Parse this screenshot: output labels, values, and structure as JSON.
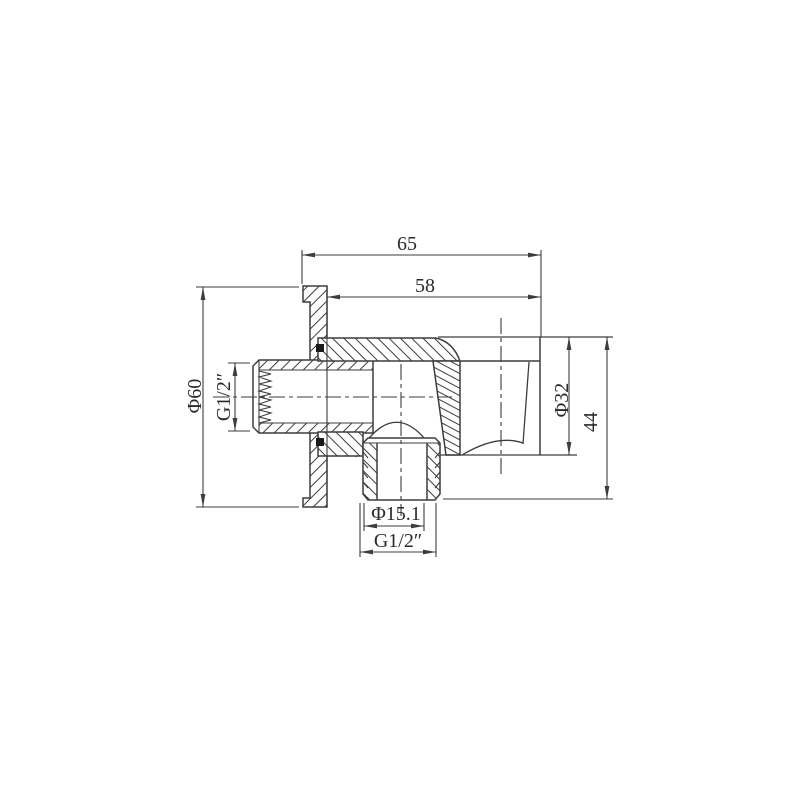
{
  "page": {
    "background": "#ffffff"
  },
  "drawing": {
    "kind": "sectional technical drawing",
    "dimensions": {
      "overall_width": "65",
      "body_width": "58",
      "flange_diameter": "Φ60",
      "inlet_thread": "G1/2″",
      "holder_diameter": "Φ32",
      "holder_height": "44",
      "outlet_bore": "Φ15.1",
      "outlet_thread": "G1/2″"
    },
    "colors": {
      "line": "#3d3d3d",
      "text": "#2a2a2a",
      "seal": "#1a1a1a"
    }
  }
}
